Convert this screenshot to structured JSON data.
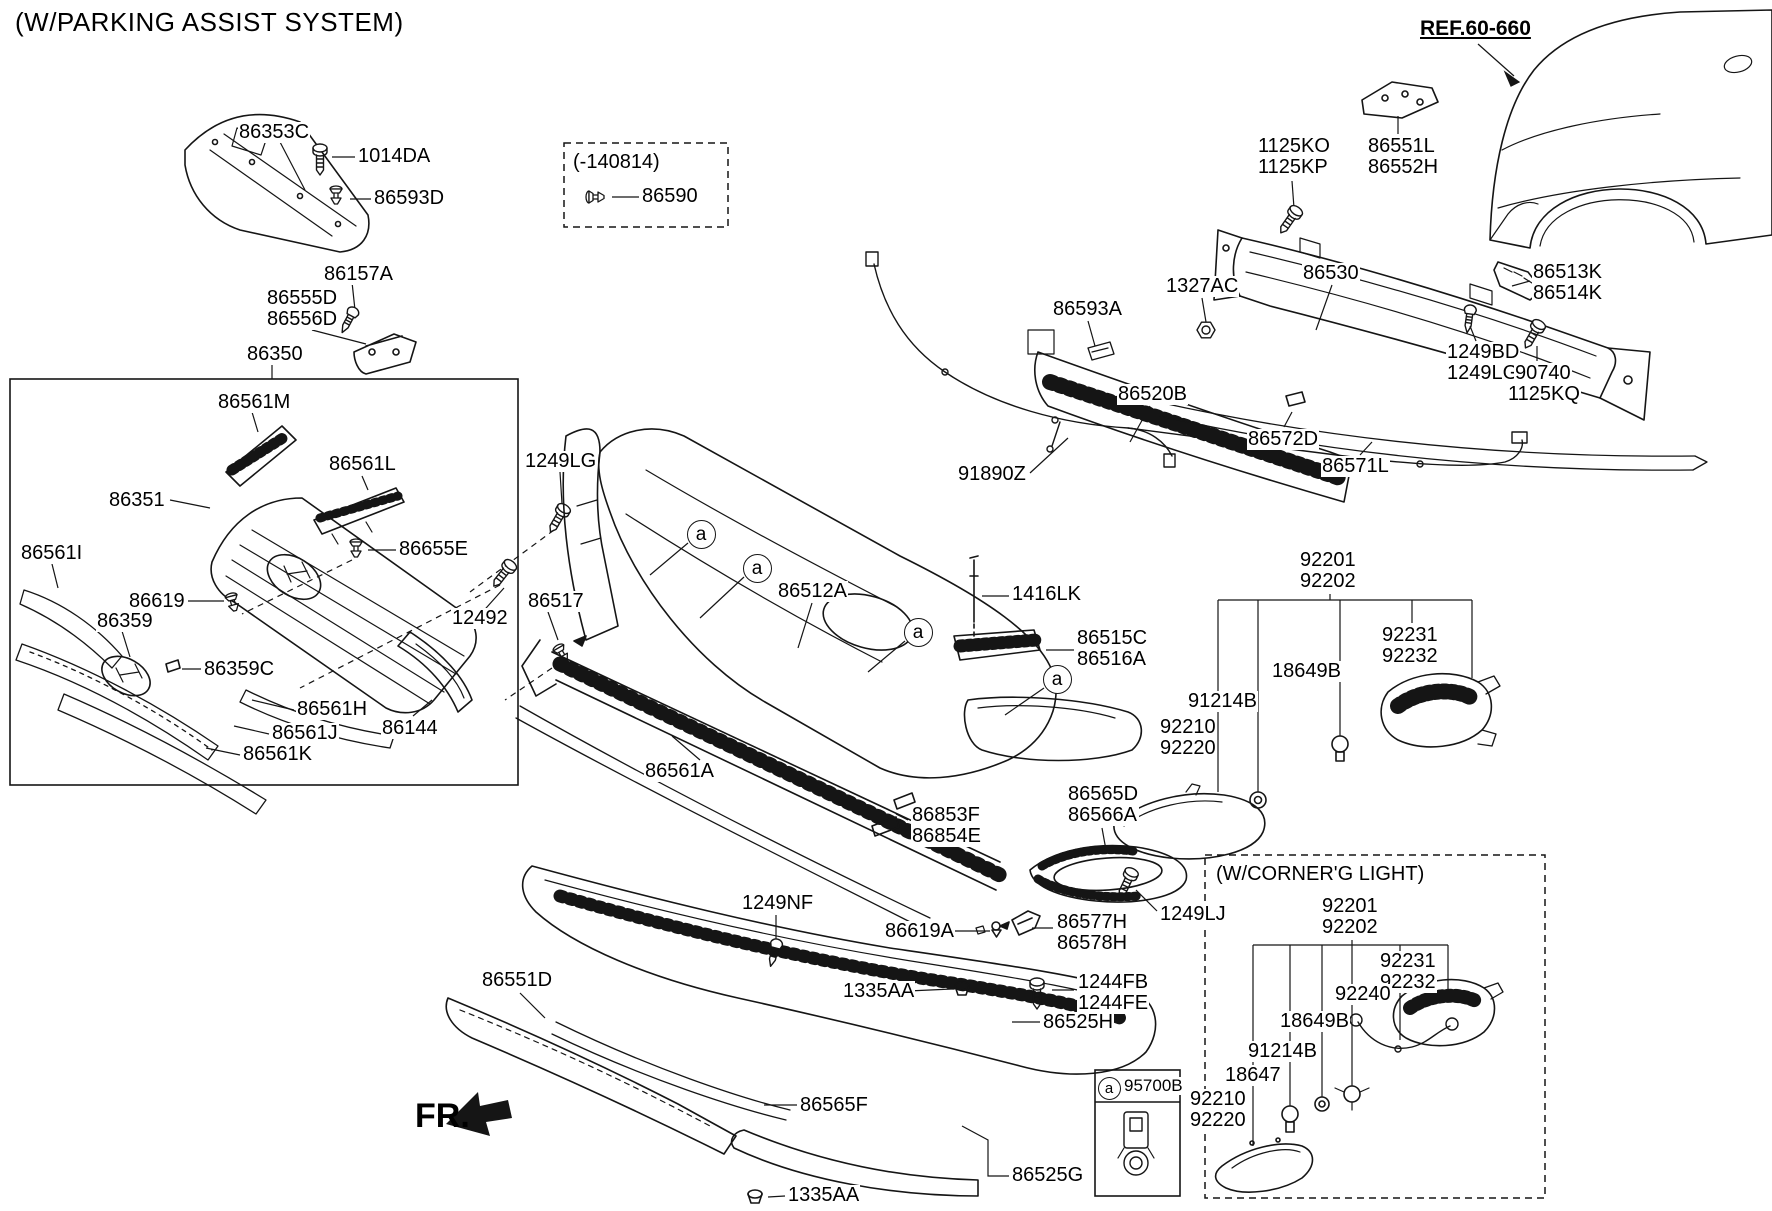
{
  "title": "(W/PARKING ASSIST SYSTEM)",
  "direction_label": "FR.",
  "callout_marker_char": "a",
  "colors": {
    "line": "#151515",
    "text": "#000000",
    "background": "#ffffff"
  },
  "boxes": {
    "variant_note": "(-140814)",
    "grille_assembly": "86350",
    "corner_light_note": "(W/CORNER'G LIGHT)",
    "sensor_part": "95700B"
  },
  "part_labels": [
    {
      "id": "86353c",
      "text": "86353C",
      "x": 238,
      "y": 122
    },
    {
      "id": "1014da",
      "text": "1014DA",
      "x": 357,
      "y": 146
    },
    {
      "id": "86593d",
      "text": "86593D",
      "x": 373,
      "y": 188
    },
    {
      "id": "variant-title",
      "text": "(-140814)",
      "x": 572,
      "y": 152
    },
    {
      "id": "86590",
      "text": "86590",
      "x": 641,
      "y": 186
    },
    {
      "id": "86157a",
      "text": "86157A",
      "x": 323,
      "y": 264
    },
    {
      "id": "86555d-86556d",
      "text": "86555D\n86556D",
      "x": 266,
      "y": 288
    },
    {
      "id": "86350",
      "text": "86350",
      "x": 246,
      "y": 344
    },
    {
      "id": "86561m",
      "text": "86561M",
      "x": 217,
      "y": 392
    },
    {
      "id": "86561l",
      "text": "86561L",
      "x": 328,
      "y": 454
    },
    {
      "id": "86351",
      "text": "86351",
      "x": 108,
      "y": 490
    },
    {
      "id": "86561i",
      "text": "86561I",
      "x": 20,
      "y": 543
    },
    {
      "id": "86655e",
      "text": "86655E",
      "x": 398,
      "y": 539
    },
    {
      "id": "86619",
      "text": "86619",
      "x": 128,
      "y": 591
    },
    {
      "id": "12492",
      "text": "12492",
      "x": 451,
      "y": 608
    },
    {
      "id": "86359",
      "text": "86359",
      "x": 96,
      "y": 611
    },
    {
      "id": "86359c",
      "text": "86359C",
      "x": 203,
      "y": 659
    },
    {
      "id": "86561h",
      "text": "86561H",
      "x": 296,
      "y": 699
    },
    {
      "id": "86561j",
      "text": "86561J",
      "x": 271,
      "y": 723
    },
    {
      "id": "86144",
      "text": "86144",
      "x": 381,
      "y": 718
    },
    {
      "id": "86561k",
      "text": "86561K",
      "x": 242,
      "y": 744
    },
    {
      "id": "1249lg-left",
      "text": "1249LG",
      "x": 524,
      "y": 451
    },
    {
      "id": "86517",
      "text": "86517",
      "x": 527,
      "y": 591
    },
    {
      "id": "86512a",
      "text": "86512A",
      "x": 777,
      "y": 581
    },
    {
      "id": "1416lk",
      "text": "1416LK",
      "x": 1011,
      "y": 584
    },
    {
      "id": "86515c-86516a",
      "text": "86515C\n86516A",
      "x": 1076,
      "y": 628
    },
    {
      "id": "86561a",
      "text": "86561A",
      "x": 644,
      "y": 761
    },
    {
      "id": "86853f-86854e",
      "text": "86853F\n86854E",
      "x": 911,
      "y": 805
    },
    {
      "id": "86565d-86566a",
      "text": "86565D\n86566A",
      "x": 1067,
      "y": 784
    },
    {
      "id": "1249nf",
      "text": "1249NF",
      "x": 741,
      "y": 893
    },
    {
      "id": "86619a",
      "text": "86619A",
      "x": 884,
      "y": 921
    },
    {
      "id": "86577h-86578h",
      "text": "86577H\n86578H",
      "x": 1056,
      "y": 912
    },
    {
      "id": "1249lj",
      "text": "1249LJ",
      "x": 1159,
      "y": 904
    },
    {
      "id": "1335aa-upper",
      "text": "1335AA",
      "x": 842,
      "y": 981
    },
    {
      "id": "1244fb-1244fe",
      "text": "1244FB\n1244FE",
      "x": 1077,
      "y": 972
    },
    {
      "id": "86525h",
      "text": "86525H",
      "x": 1042,
      "y": 1012
    },
    {
      "id": "86551d",
      "text": "86551D",
      "x": 481,
      "y": 970
    },
    {
      "id": "86565f",
      "text": "86565F",
      "x": 799,
      "y": 1095
    },
    {
      "id": "86525g",
      "text": "86525G",
      "x": 1011,
      "y": 1165
    },
    {
      "id": "1335aa-lower",
      "text": "1335AA",
      "x": 787,
      "y": 1185
    },
    {
      "id": "91890z",
      "text": "91890Z",
      "x": 957,
      "y": 464
    },
    {
      "id": "86593a",
      "text": "86593A",
      "x": 1052,
      "y": 299
    },
    {
      "id": "1327ac",
      "text": "1327AC",
      "x": 1165,
      "y": 276
    },
    {
      "id": "86530",
      "text": "86530",
      "x": 1302,
      "y": 263
    },
    {
      "id": "1125ko-1125kp",
      "text": "1125KO\n1125KP",
      "x": 1257,
      "y": 136
    },
    {
      "id": "86551l-86552h",
      "text": "86551L\n86552H",
      "x": 1367,
      "y": 136
    },
    {
      "id": "ref-60-660",
      "text": "REF.60-660",
      "x": 1419,
      "y": 18,
      "cls": "ref"
    },
    {
      "id": "86513k-86514k",
      "text": "86513K\n86514K",
      "x": 1532,
      "y": 262
    },
    {
      "id": "1249bd-1249lg",
      "text": "1249BD\n1249LG",
      "x": 1446,
      "y": 342
    },
    {
      "id": "90740",
      "text": "90740",
      "x": 1514,
      "y": 363
    },
    {
      "id": "1125kq",
      "text": "1125KQ",
      "x": 1507,
      "y": 384
    },
    {
      "id": "86520b",
      "text": "86520B",
      "x": 1117,
      "y": 384
    },
    {
      "id": "86572d",
      "text": "86572D",
      "x": 1247,
      "y": 429
    },
    {
      "id": "86571l",
      "text": "86571L",
      "x": 1321,
      "y": 456
    },
    {
      "id": "92201-92202-main",
      "text": "92201\n92202",
      "x": 1299,
      "y": 550
    },
    {
      "id": "92231-92232-main",
      "text": "92231\n92232",
      "x": 1381,
      "y": 625
    },
    {
      "id": "18649b-main",
      "text": "18649B",
      "x": 1271,
      "y": 661
    },
    {
      "id": "91214b-main",
      "text": "91214B",
      "x": 1187,
      "y": 691
    },
    {
      "id": "92210-92220-main",
      "text": "92210\n92220",
      "x": 1159,
      "y": 717
    },
    {
      "id": "corner-title",
      "text": "(W/CORNER'G LIGHT)",
      "x": 1215,
      "y": 864
    },
    {
      "id": "92201-92202-corner",
      "text": "92201\n92202",
      "x": 1321,
      "y": 896
    },
    {
      "id": "92231-92232-corner",
      "text": "92231\n92232",
      "x": 1379,
      "y": 951
    },
    {
      "id": "92240",
      "text": "92240",
      "x": 1334,
      "y": 984
    },
    {
      "id": "18649b-corner",
      "text": "18649B",
      "x": 1279,
      "y": 1011
    },
    {
      "id": "91214b-corner",
      "text": "91214B",
      "x": 1247,
      "y": 1041
    },
    {
      "id": "18647",
      "text": "18647",
      "x": 1224,
      "y": 1065
    },
    {
      "id": "92210-92220-corner",
      "text": "92210\n92220",
      "x": 1189,
      "y": 1089
    },
    {
      "id": "95700b",
      "text": "95700B",
      "x": 1123,
      "y": 1077,
      "cls": "small"
    }
  ],
  "callout_markers": [
    {
      "id": "a-1",
      "x": 700,
      "y": 533
    },
    {
      "id": "a-2",
      "x": 756,
      "y": 567
    },
    {
      "id": "a-3",
      "x": 917,
      "y": 631
    },
    {
      "id": "a-4",
      "x": 1056,
      "y": 678
    },
    {
      "id": "a-sensor-box",
      "x": 1108,
      "y": 1087,
      "small": true
    }
  ]
}
